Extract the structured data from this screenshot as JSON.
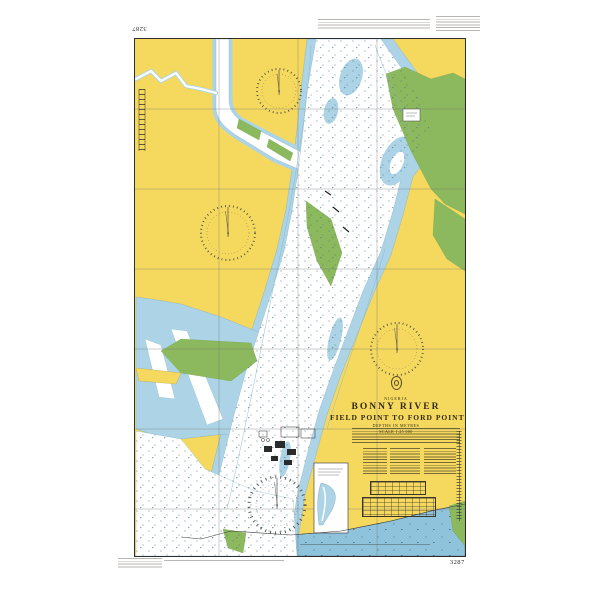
{
  "chart": {
    "number": "3287",
    "country": "NIGERIA",
    "title": "BONNY RIVER",
    "subtitle": "FIELD POINT TO FORD POINT",
    "depths_note": "DEPTHS IN METRES",
    "scale_note": "SCALE 1:25 000",
    "colors": {
      "paper": "#FFFFFF",
      "land": "#F5D95F",
      "shallow_water": "#ACD4E6",
      "sea": "#8FC2DB",
      "deep_water": "#FFFFFF",
      "mangrove_green": "#8CB95D",
      "ink": "#2E2E2E"
    },
    "features": [
      "compass-rose-north",
      "compass-rose-west",
      "compass-rose-east",
      "compass-rose-south",
      "main-river-channel",
      "tributary-creek",
      "mangrove-areas",
      "industrial-works",
      "inset-panel",
      "tidal-tables",
      "notes-block"
    ]
  },
  "corner_labels": {
    "top_left": "3287",
    "bottom_right": "3287"
  }
}
